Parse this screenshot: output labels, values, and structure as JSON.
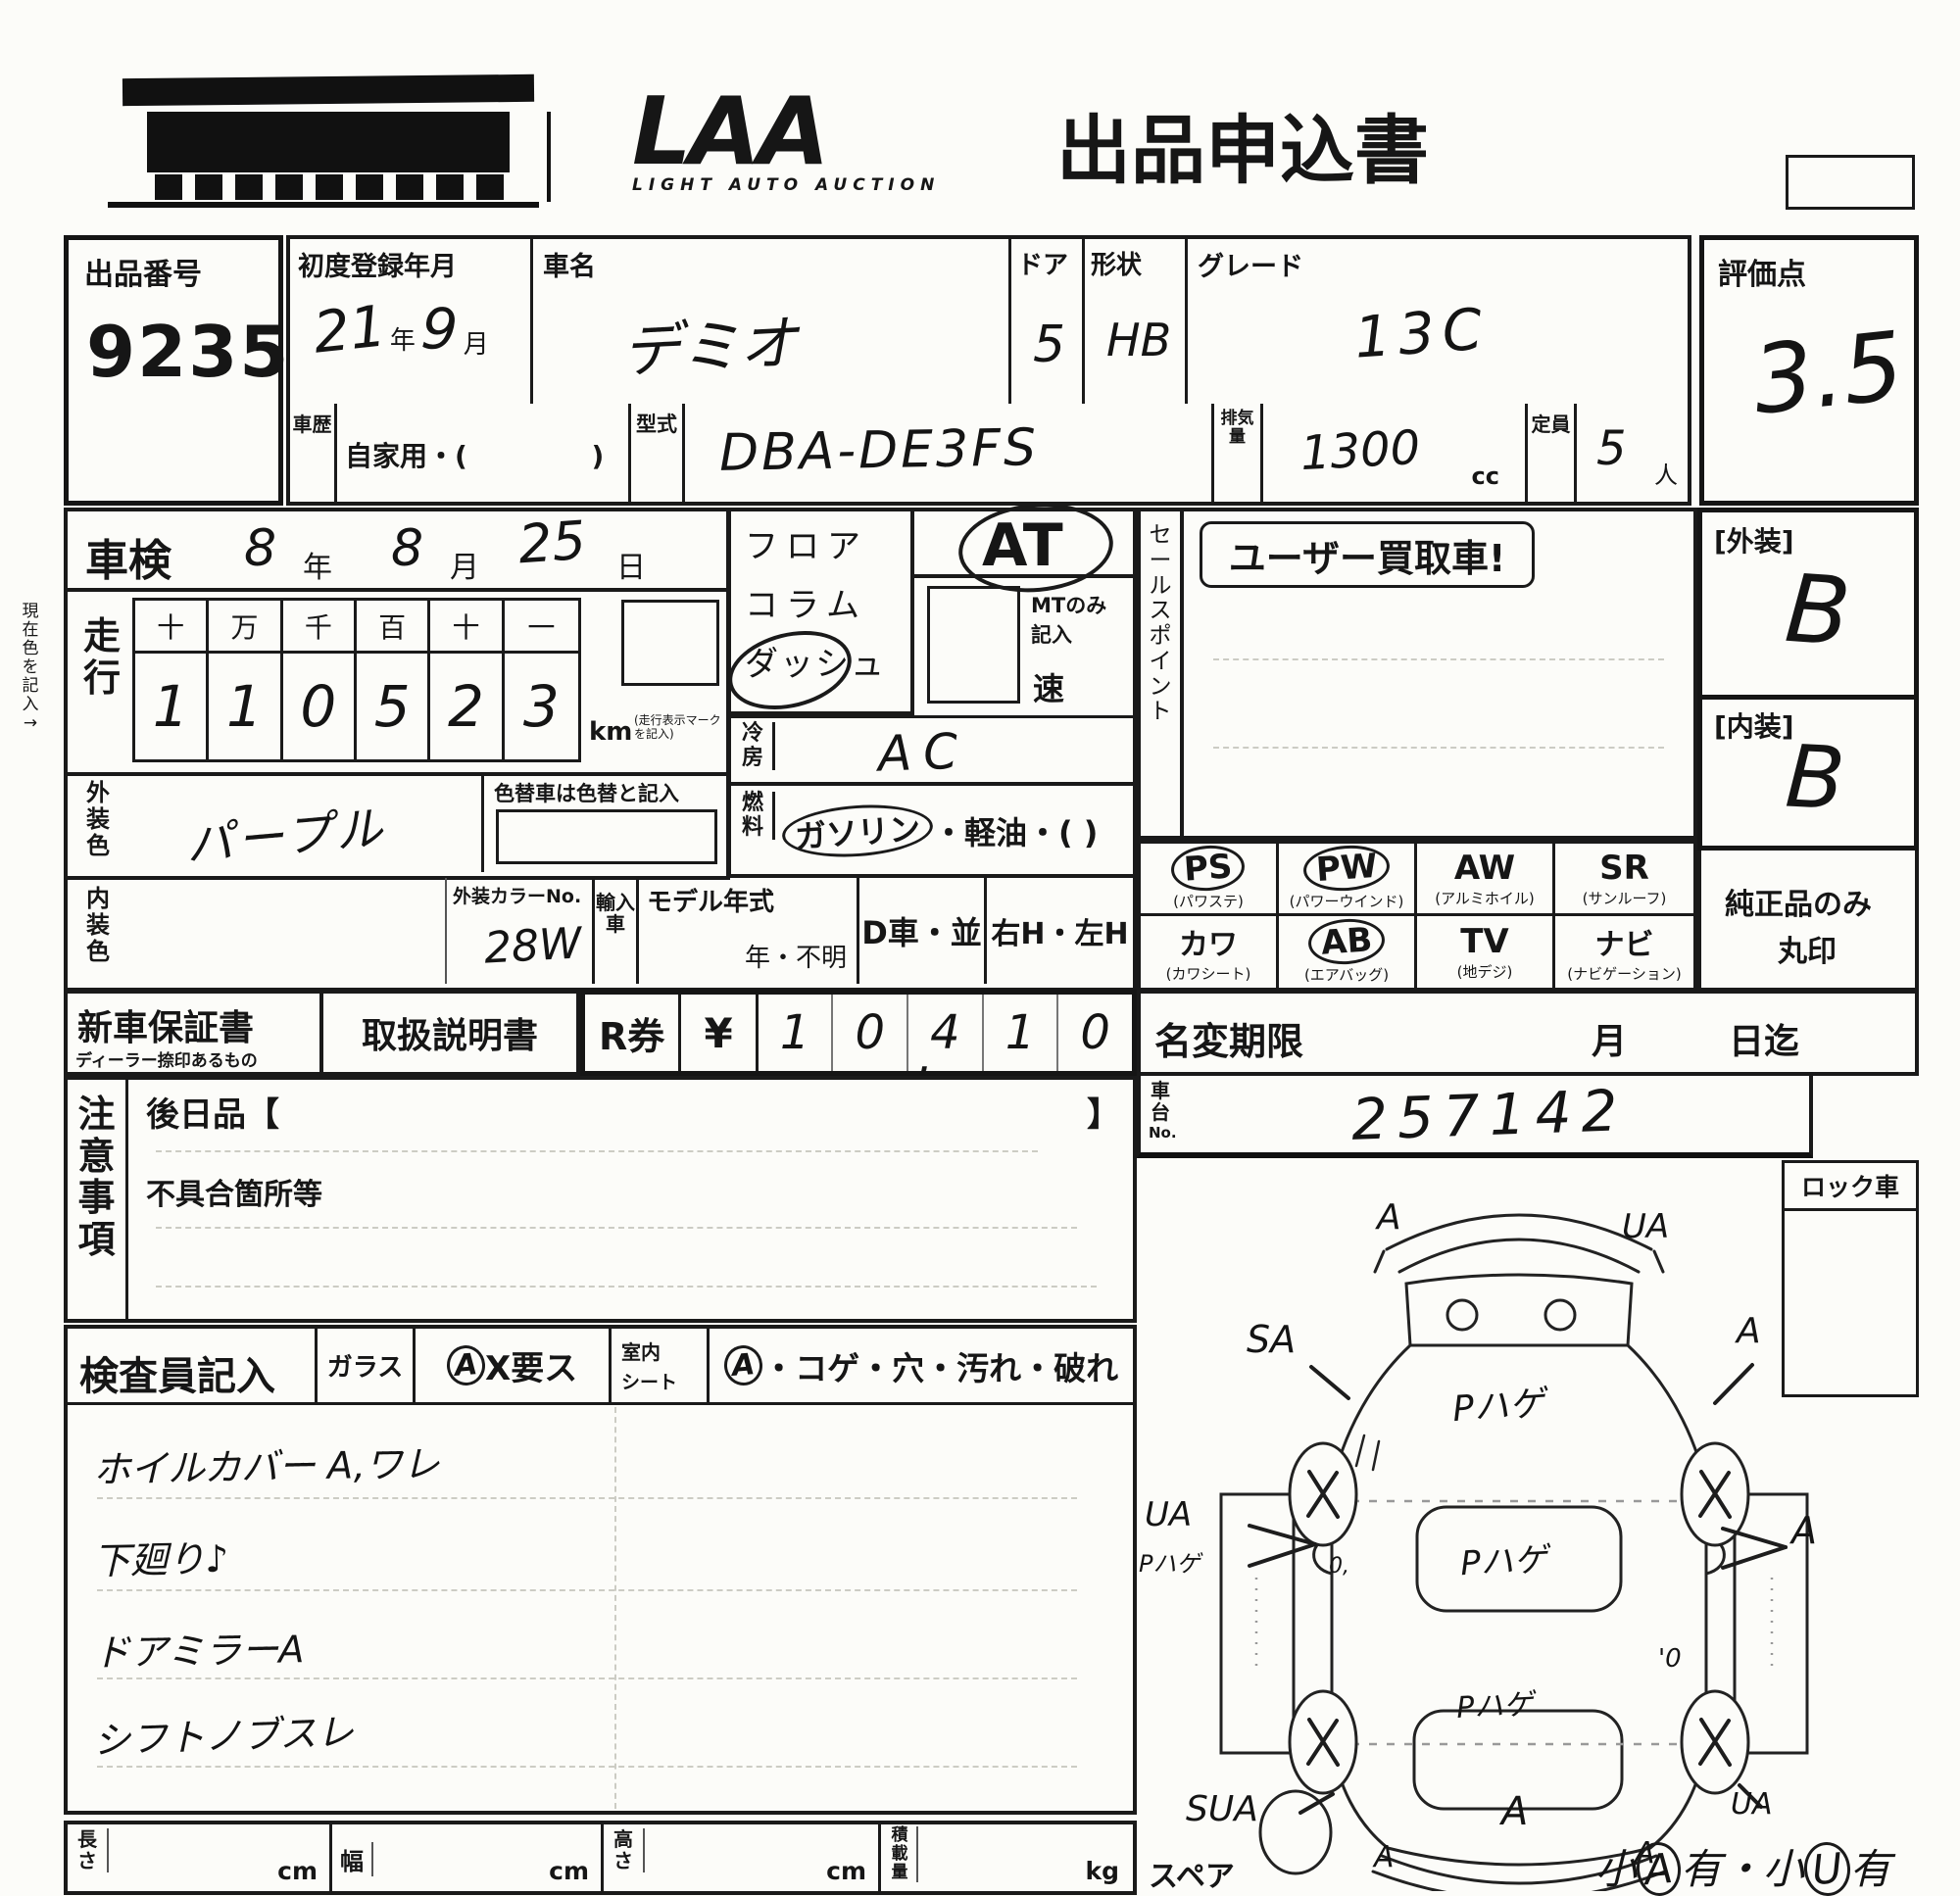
{
  "header": {
    "title": "出品申込書",
    "logo_text": "LAA",
    "logo_sub": "LIGHT AUTO AUCTION"
  },
  "lot": {
    "label": "出品番号",
    "number": "9235"
  },
  "reg": {
    "label": "初度登録年月",
    "year": "21",
    "y_unit": "年",
    "month": "9",
    "m_unit": "月"
  },
  "car": {
    "label": "車名",
    "value": "デミオ"
  },
  "door": {
    "label": "ドア",
    "value": "5"
  },
  "shape": {
    "label": "形状",
    "value": "HB"
  },
  "grade": {
    "label": "グレード",
    "value": "13C"
  },
  "score": {
    "label": "評価点",
    "value": "3.5"
  },
  "history": {
    "label": "車歴",
    "value": "自家用・(             )"
  },
  "model": {
    "label": "型式",
    "value": "DBA-DE3FS"
  },
  "disp": {
    "label": "排気量",
    "value": "1300",
    "unit": "cc"
  },
  "cap": {
    "label": "定員",
    "value": "5",
    "unit": "人"
  },
  "shaken": {
    "label": "車検",
    "year": "8",
    "y_unit": "年",
    "month": "8",
    "m_unit": "月",
    "day": "25",
    "d_unit": "日"
  },
  "mileage": {
    "label": "走行",
    "headers": [
      "十",
      "万",
      "千",
      "百",
      "十",
      "一"
    ],
    "digits": [
      "1",
      "1",
      "0",
      "5",
      "2",
      "3"
    ],
    "unit": "km",
    "note": "(走行表示マーク を記入)"
  },
  "margin_note": "現在色を記入→",
  "ext_color": {
    "label": "外装色",
    "value": "パープル",
    "note": "色替車は色替と記入"
  },
  "int_color": {
    "label": "内装色",
    "value": ""
  },
  "color_no": {
    "label": "外装カラーNo.",
    "value": "28W"
  },
  "import_car": {
    "label": "輸入車",
    "model_year": "モデル年式",
    "year_unknown": "年・不明",
    "d_car": "D車・並",
    "handle": "右H・左H"
  },
  "trans": {
    "line1": "フロア",
    "line2": "コラム",
    "line3": "ダッシュ",
    "at": "AT",
    "mt_note1": "MTのみ",
    "mt_note2": "記入",
    "speed": "速"
  },
  "cool": {
    "label": "冷房",
    "value": "AC"
  },
  "fuel": {
    "label": "燃料",
    "opt1": "ガソリン",
    "rest": "・軽油・(            )"
  },
  "sales": {
    "label": "セールスポイント",
    "value": "ユーザー買取車!"
  },
  "ext_grade": {
    "label": "[外装]",
    "value": "B"
  },
  "int_grade": {
    "label": "[内装]",
    "value": "B"
  },
  "equip": {
    "note1": "純正品のみ",
    "note2": "丸印",
    "items": [
      {
        "code": "PS",
        "name": "(パワステ)",
        "circled": true
      },
      {
        "code": "PW",
        "name": "(パワーウインド)",
        "circled": true
      },
      {
        "code": "AW",
        "name": "(アルミホイル)",
        "circled": false
      },
      {
        "code": "SR",
        "name": "(サンルーフ)",
        "circled": false
      },
      {
        "code": "カワ",
        "name": "(カワシート)",
        "circled": false
      },
      {
        "code": "AB",
        "name": "(エアバッグ)",
        "circled": true
      },
      {
        "code": "TV",
        "name": "(地デジ)",
        "circled": false
      },
      {
        "code": "ナビ",
        "name": "(ナビゲーション)",
        "circled": false
      }
    ]
  },
  "warranty": {
    "label": "新車保証書",
    "sub": "ディーラー捺印あるもの"
  },
  "manual": {
    "label": "取扱説明書"
  },
  "rticket": {
    "label": "R券",
    "yen": "¥",
    "digits": [
      "1",
      "0",
      "4",
      "1",
      "0"
    ],
    "comma": ","
  },
  "namechange": {
    "label": "名変期限",
    "month": "月",
    "day": "日迄"
  },
  "chassis": {
    "label1": "車台",
    "label2": "No.",
    "value": "257142"
  },
  "lock": {
    "label": "ロック車"
  },
  "caution": {
    "label": "注意事項",
    "later": "後日品【",
    "later_close": "】",
    "defect": "不具合箇所等"
  },
  "inspector": {
    "label": "検査員記入",
    "glass": "ガラス",
    "glass_mark": "A",
    "glass_note": "X要ス",
    "seat1": "室内",
    "seat2": "シート",
    "seat_mark": "A",
    "seat_note": "・コゲ・穴・汚れ・破れ",
    "notes": [
      "ホイルカバー A,ワレ",
      "下廻り♪",
      "ドアミラーA",
      "シフトノブスレ"
    ]
  },
  "dims": {
    "length": "長さ",
    "width": "幅",
    "height": "高さ",
    "load": "積載量",
    "cm": "cm",
    "kg": "kg"
  },
  "diagram": {
    "spare": "スペア",
    "ann": {
      "fl": "A",
      "fr": "UA",
      "sa": "SA",
      "fra": "A",
      "hood": "Pハゲ",
      "mid_left": "UA",
      "mid_left2": "Pハゲ",
      "mid_right": "A",
      "roof": "Pハゲ",
      "rear": "Pハゲ",
      "o_left": "0,",
      "o_right": "'0",
      "sua": "SUA",
      "ua_br": "UA",
      "trunk": "A",
      "bl": "A",
      "br": "A"
    },
    "bottom_note": {
      "p1": "小",
      "a": "A",
      "p2": "有・小",
      "b": "U",
      "p3": "有"
    }
  }
}
